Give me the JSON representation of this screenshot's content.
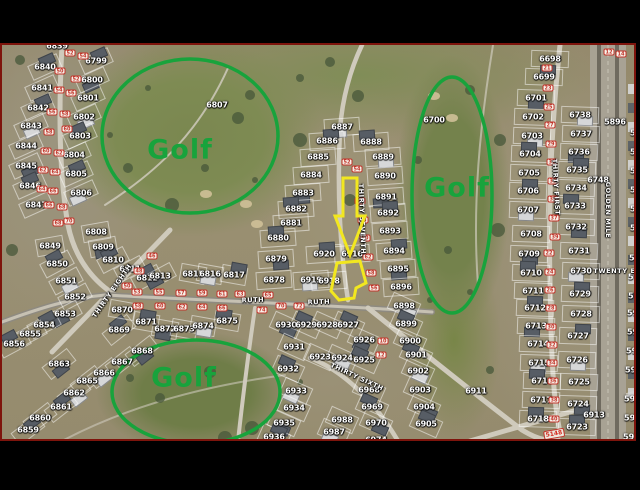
{
  "letterbox_color": "#000000",
  "map": {
    "border_color": "#7e140c",
    "annotation_green": "#18a33c",
    "highlight_yellow": "#f2e71f",
    "golf_texts": [
      {
        "text": "Golf",
        "x": 180,
        "y": 150
      },
      {
        "text": "Golf",
        "x": 457,
        "y": 188
      },
      {
        "text": "Golf",
        "x": 184,
        "y": 378
      }
    ],
    "golf_ellipses": [
      {
        "cx": 190,
        "cy": 136,
        "rx": 88,
        "ry": 77
      },
      {
        "cx": 452,
        "cy": 195,
        "rx": 40,
        "ry": 118
      },
      {
        "cx": 196,
        "cy": 392,
        "rx": 84,
        "ry": 52
      }
    ],
    "highlight": {
      "target_parcel": "6916",
      "arrow_points": "343,178 357,178 357,216 365,216 350,255 335,216 343,216",
      "parcel_points": "337,263 360,261 366,283 356,288 354,298 339,300 331,291"
    },
    "streets": [
      {
        "name": "RUTH",
        "x": 253,
        "y": 300,
        "angle": -2
      },
      {
        "name": "RUTH",
        "x": 319,
        "y": 302,
        "angle": -2
      },
      {
        "name": "THIRTY SEVENTH",
        "x": 362,
        "y": 219,
        "angle": 88
      },
      {
        "name": "THIRTY EIGHTH",
        "x": 112,
        "y": 291,
        "angle": -55
      },
      {
        "name": "THIRTY SIXTH",
        "x": 357,
        "y": 377,
        "angle": 25
      },
      {
        "name": "THIRTY FIRST",
        "x": 556,
        "y": 187,
        "angle": 87
      },
      {
        "name": "GOLDEN MILE",
        "x": 608,
        "y": 210,
        "angle": 90
      },
      {
        "name": "TWENTY EI",
        "x": 616,
        "y": 271,
        "angle": 0
      }
    ],
    "road_label": {
      "text": "5148",
      "x": 554,
      "y": 434
    },
    "parcels": [
      [
        "6839",
        57,
        46
      ],
      [
        "6840",
        45,
        67
      ],
      [
        "6841",
        42,
        88
      ],
      [
        "6842",
        38,
        108
      ],
      [
        "6843",
        31,
        126
      ],
      [
        "6844",
        26,
        146
      ],
      [
        "6845",
        26,
        166
      ],
      [
        "6846",
        30,
        186
      ],
      [
        "6847",
        36,
        205
      ],
      [
        "6799",
        96,
        61
      ],
      [
        "6800",
        92,
        80
      ],
      [
        "6801",
        88,
        98
      ],
      [
        "6802",
        84,
        117
      ],
      [
        "6803",
        80,
        136
      ],
      [
        "6804",
        74,
        155
      ],
      [
        "6805",
        76,
        174
      ],
      [
        "6806",
        81,
        193
      ],
      [
        "6808",
        96,
        232
      ],
      [
        "6809",
        103,
        247
      ],
      [
        "6810",
        113,
        260
      ],
      [
        "6811",
        130,
        269
      ],
      [
        "6812",
        147,
        278
      ],
      [
        "6813",
        160,
        276
      ],
      [
        "6815",
        193,
        274
      ],
      [
        "6816",
        210,
        274
      ],
      [
        "6817",
        234,
        275
      ],
      [
        "6849",
        50,
        246
      ],
      [
        "6850",
        57,
        264
      ],
      [
        "6851",
        66,
        281
      ],
      [
        "6852",
        75,
        297
      ],
      [
        "6853",
        65,
        314
      ],
      [
        "6854",
        44,
        325
      ],
      [
        "6855",
        30,
        334
      ],
      [
        "6856",
        14,
        344
      ],
      [
        "6863",
        59,
        364
      ],
      [
        "6865",
        87,
        381
      ],
      [
        "6862",
        74,
        393
      ],
      [
        "6861",
        61,
        407
      ],
      [
        "6860",
        40,
        418
      ],
      [
        "6859",
        28,
        430
      ],
      [
        "6866",
        104,
        373
      ],
      [
        "6867",
        122,
        362
      ],
      [
        "6868",
        142,
        351
      ],
      [
        "6869",
        119,
        330
      ],
      [
        "6870",
        122,
        310
      ],
      [
        "6871",
        146,
        322
      ],
      [
        "6872",
        165,
        329
      ],
      [
        "6873",
        184,
        329
      ],
      [
        "6874",
        203,
        326
      ],
      [
        "6875",
        227,
        321
      ],
      [
        "6807",
        217,
        105
      ],
      [
        "6700",
        434,
        120
      ],
      [
        "6911",
        476,
        391
      ],
      [
        "6884",
        311,
        175
      ],
      [
        "6883",
        303,
        193
      ],
      [
        "6882",
        296,
        209
      ],
      [
        "6881",
        291,
        223
      ],
      [
        "6880",
        278,
        238
      ],
      [
        "6879",
        276,
        259
      ],
      [
        "6878",
        274,
        280
      ],
      [
        "6887",
        342,
        127
      ],
      [
        "6886",
        327,
        141
      ],
      [
        "6885",
        318,
        157
      ],
      [
        "6888",
        371,
        142
      ],
      [
        "6889",
        383,
        157
      ],
      [
        "6890",
        385,
        176
      ],
      [
        "6891",
        386,
        197
      ],
      [
        "6892",
        388,
        213
      ],
      [
        "6893",
        390,
        231
      ],
      [
        "6894",
        394,
        251
      ],
      [
        "6895",
        398,
        269
      ],
      [
        "6896",
        401,
        287
      ],
      [
        "6898",
        404,
        306
      ],
      [
        "6899",
        406,
        324
      ],
      [
        "6916",
        352,
        254
      ],
      [
        "6920",
        324,
        254
      ],
      [
        "6919",
        311,
        280
      ],
      [
        "6918",
        329,
        281
      ],
      [
        "6930",
        286,
        325
      ],
      [
        "6929",
        306,
        325
      ],
      [
        "6928",
        327,
        325
      ],
      [
        "6927",
        348,
        325
      ],
      [
        "6926",
        364,
        340
      ],
      [
        "6923",
        320,
        357
      ],
      [
        "6924",
        342,
        358
      ],
      [
        "6925",
        364,
        360
      ],
      [
        "6931",
        294,
        347
      ],
      [
        "6932",
        288,
        369
      ],
      [
        "6933",
        296,
        391
      ],
      [
        "6934",
        294,
        408
      ],
      [
        "6935",
        284,
        423
      ],
      [
        "6936",
        274,
        437
      ],
      [
        "6968",
        369,
        390
      ],
      [
        "6969",
        372,
        407
      ],
      [
        "6970",
        376,
        423
      ],
      [
        "6988",
        342,
        420
      ],
      [
        "6987",
        334,
        432
      ],
      [
        "6974",
        376,
        440
      ],
      [
        "6900",
        410,
        341
      ],
      [
        "6901",
        416,
        355
      ],
      [
        "6902",
        418,
        371
      ],
      [
        "6903",
        420,
        390
      ],
      [
        "6904",
        424,
        407
      ],
      [
        "6905",
        426,
        424
      ],
      [
        "6698",
        550,
        59
      ],
      [
        "6699",
        544,
        77
      ],
      [
        "6701",
        536,
        98
      ],
      [
        "6702",
        533,
        117
      ],
      [
        "6703",
        532,
        136
      ],
      [
        "6704",
        530,
        154
      ],
      [
        "6705",
        529,
        173
      ],
      [
        "6706",
        528,
        191
      ],
      [
        "6707",
        528,
        210
      ],
      [
        "6708",
        531,
        234
      ],
      [
        "6709",
        529,
        254
      ],
      [
        "6710",
        531,
        273
      ],
      [
        "6711",
        533,
        291
      ],
      [
        "6712",
        535,
        308
      ],
      [
        "6713",
        536,
        326
      ],
      [
        "6714",
        538,
        344
      ],
      [
        "6715",
        539,
        363
      ],
      [
        "6716",
        542,
        381
      ],
      [
        "6717",
        541,
        400
      ],
      [
        "6718",
        538,
        419
      ],
      [
        "6738",
        580,
        115
      ],
      [
        "6737",
        581,
        134
      ],
      [
        "6736",
        579,
        152
      ],
      [
        "6735",
        577,
        170
      ],
      [
        "6734",
        576,
        188
      ],
      [
        "6733",
        575,
        206
      ],
      [
        "6732",
        576,
        227
      ],
      [
        "6731",
        579,
        251
      ],
      [
        "6730",
        581,
        271
      ],
      [
        "6729",
        580,
        294
      ],
      [
        "6728",
        581,
        314
      ],
      [
        "6727",
        578,
        336
      ],
      [
        "6726",
        577,
        360
      ],
      [
        "6725",
        579,
        382
      ],
      [
        "6724",
        578,
        404
      ],
      [
        "6723",
        577,
        427
      ],
      [
        "6913",
        594,
        415
      ],
      [
        "6748",
        598,
        180
      ],
      [
        "5896",
        615,
        122
      ]
    ],
    "edge_parcels": [
      [
        "59",
        630,
        133
      ],
      [
        "59",
        630,
        152
      ],
      [
        "59",
        630,
        171
      ],
      [
        "59",
        630,
        190
      ],
      [
        "59",
        630,
        209
      ],
      [
        "59",
        630,
        228
      ],
      [
        "59",
        629,
        258
      ],
      [
        "595",
        628,
        277
      ],
      [
        "5961",
        628,
        296
      ],
      [
        "5962",
        627,
        313
      ],
      [
        "5963",
        627,
        332
      ],
      [
        "596",
        626,
        351
      ],
      [
        "596",
        625,
        370
      ],
      [
        "5965",
        624,
        399
      ],
      [
        "5966",
        624,
        418
      ],
      [
        "596",
        623,
        437
      ]
    ],
    "markers": [
      [
        "52",
        70,
        53
      ],
      [
        "54",
        83,
        56
      ],
      [
        "50",
        60,
        71
      ],
      [
        "52",
        76,
        79
      ],
      [
        "54",
        59,
        90
      ],
      [
        "56",
        71,
        93
      ],
      [
        "56",
        52,
        112
      ],
      [
        "58",
        65,
        114
      ],
      [
        "58",
        49,
        132
      ],
      [
        "60",
        67,
        129
      ],
      [
        "60",
        46,
        151
      ],
      [
        "62",
        59,
        153
      ],
      [
        "62",
        43,
        170
      ],
      [
        "64",
        55,
        172
      ],
      [
        "64",
        42,
        189
      ],
      [
        "66",
        53,
        191
      ],
      [
        "66",
        49,
        205
      ],
      [
        "68",
        62,
        207
      ],
      [
        "68",
        58,
        223
      ],
      [
        "70",
        69,
        221
      ],
      [
        "53",
        137,
        292
      ],
      [
        "55",
        159,
        292
      ],
      [
        "57",
        181,
        293
      ],
      [
        "59",
        202,
        293
      ],
      [
        "61",
        222,
        294
      ],
      [
        "63",
        240,
        294
      ],
      [
        "65",
        268,
        295
      ],
      [
        "58",
        138,
        306
      ],
      [
        "60",
        160,
        306
      ],
      [
        "62",
        182,
        307
      ],
      [
        "64",
        202,
        307
      ],
      [
        "66",
        222,
        308
      ],
      [
        "70",
        281,
        306
      ],
      [
        "72",
        299,
        306
      ],
      [
        "46",
        152,
        256
      ],
      [
        "48",
        139,
        271
      ],
      [
        "50",
        127,
        286
      ],
      [
        "52",
        347,
        162
      ],
      [
        "54",
        357,
        169
      ],
      [
        "56",
        360,
        201
      ],
      [
        "58",
        363,
        220
      ],
      [
        "60",
        365,
        238
      ],
      [
        "62",
        368,
        257
      ],
      [
        "58",
        371,
        273
      ],
      [
        "56",
        374,
        288
      ],
      [
        "21",
        547,
        68
      ],
      [
        "23",
        548,
        88
      ],
      [
        "25",
        549,
        107
      ],
      [
        "27",
        550,
        125
      ],
      [
        "29",
        551,
        144
      ],
      [
        "31",
        552,
        162
      ],
      [
        "33",
        553,
        181
      ],
      [
        "35",
        553,
        199
      ],
      [
        "37",
        554,
        218
      ],
      [
        "39",
        555,
        237
      ],
      [
        "22",
        549,
        253
      ],
      [
        "24",
        550,
        272
      ],
      [
        "26",
        550,
        290
      ],
      [
        "28",
        551,
        308
      ],
      [
        "30",
        551,
        327
      ],
      [
        "32",
        552,
        345
      ],
      [
        "34",
        552,
        363
      ],
      [
        "36",
        553,
        381
      ],
      [
        "38",
        554,
        400
      ],
      [
        "40",
        554,
        419
      ],
      [
        "10",
        383,
        341
      ],
      [
        "12",
        381,
        355
      ],
      [
        "12",
        609,
        52
      ],
      [
        "14",
        621,
        54
      ],
      [
        "74",
        262,
        310
      ]
    ]
  }
}
